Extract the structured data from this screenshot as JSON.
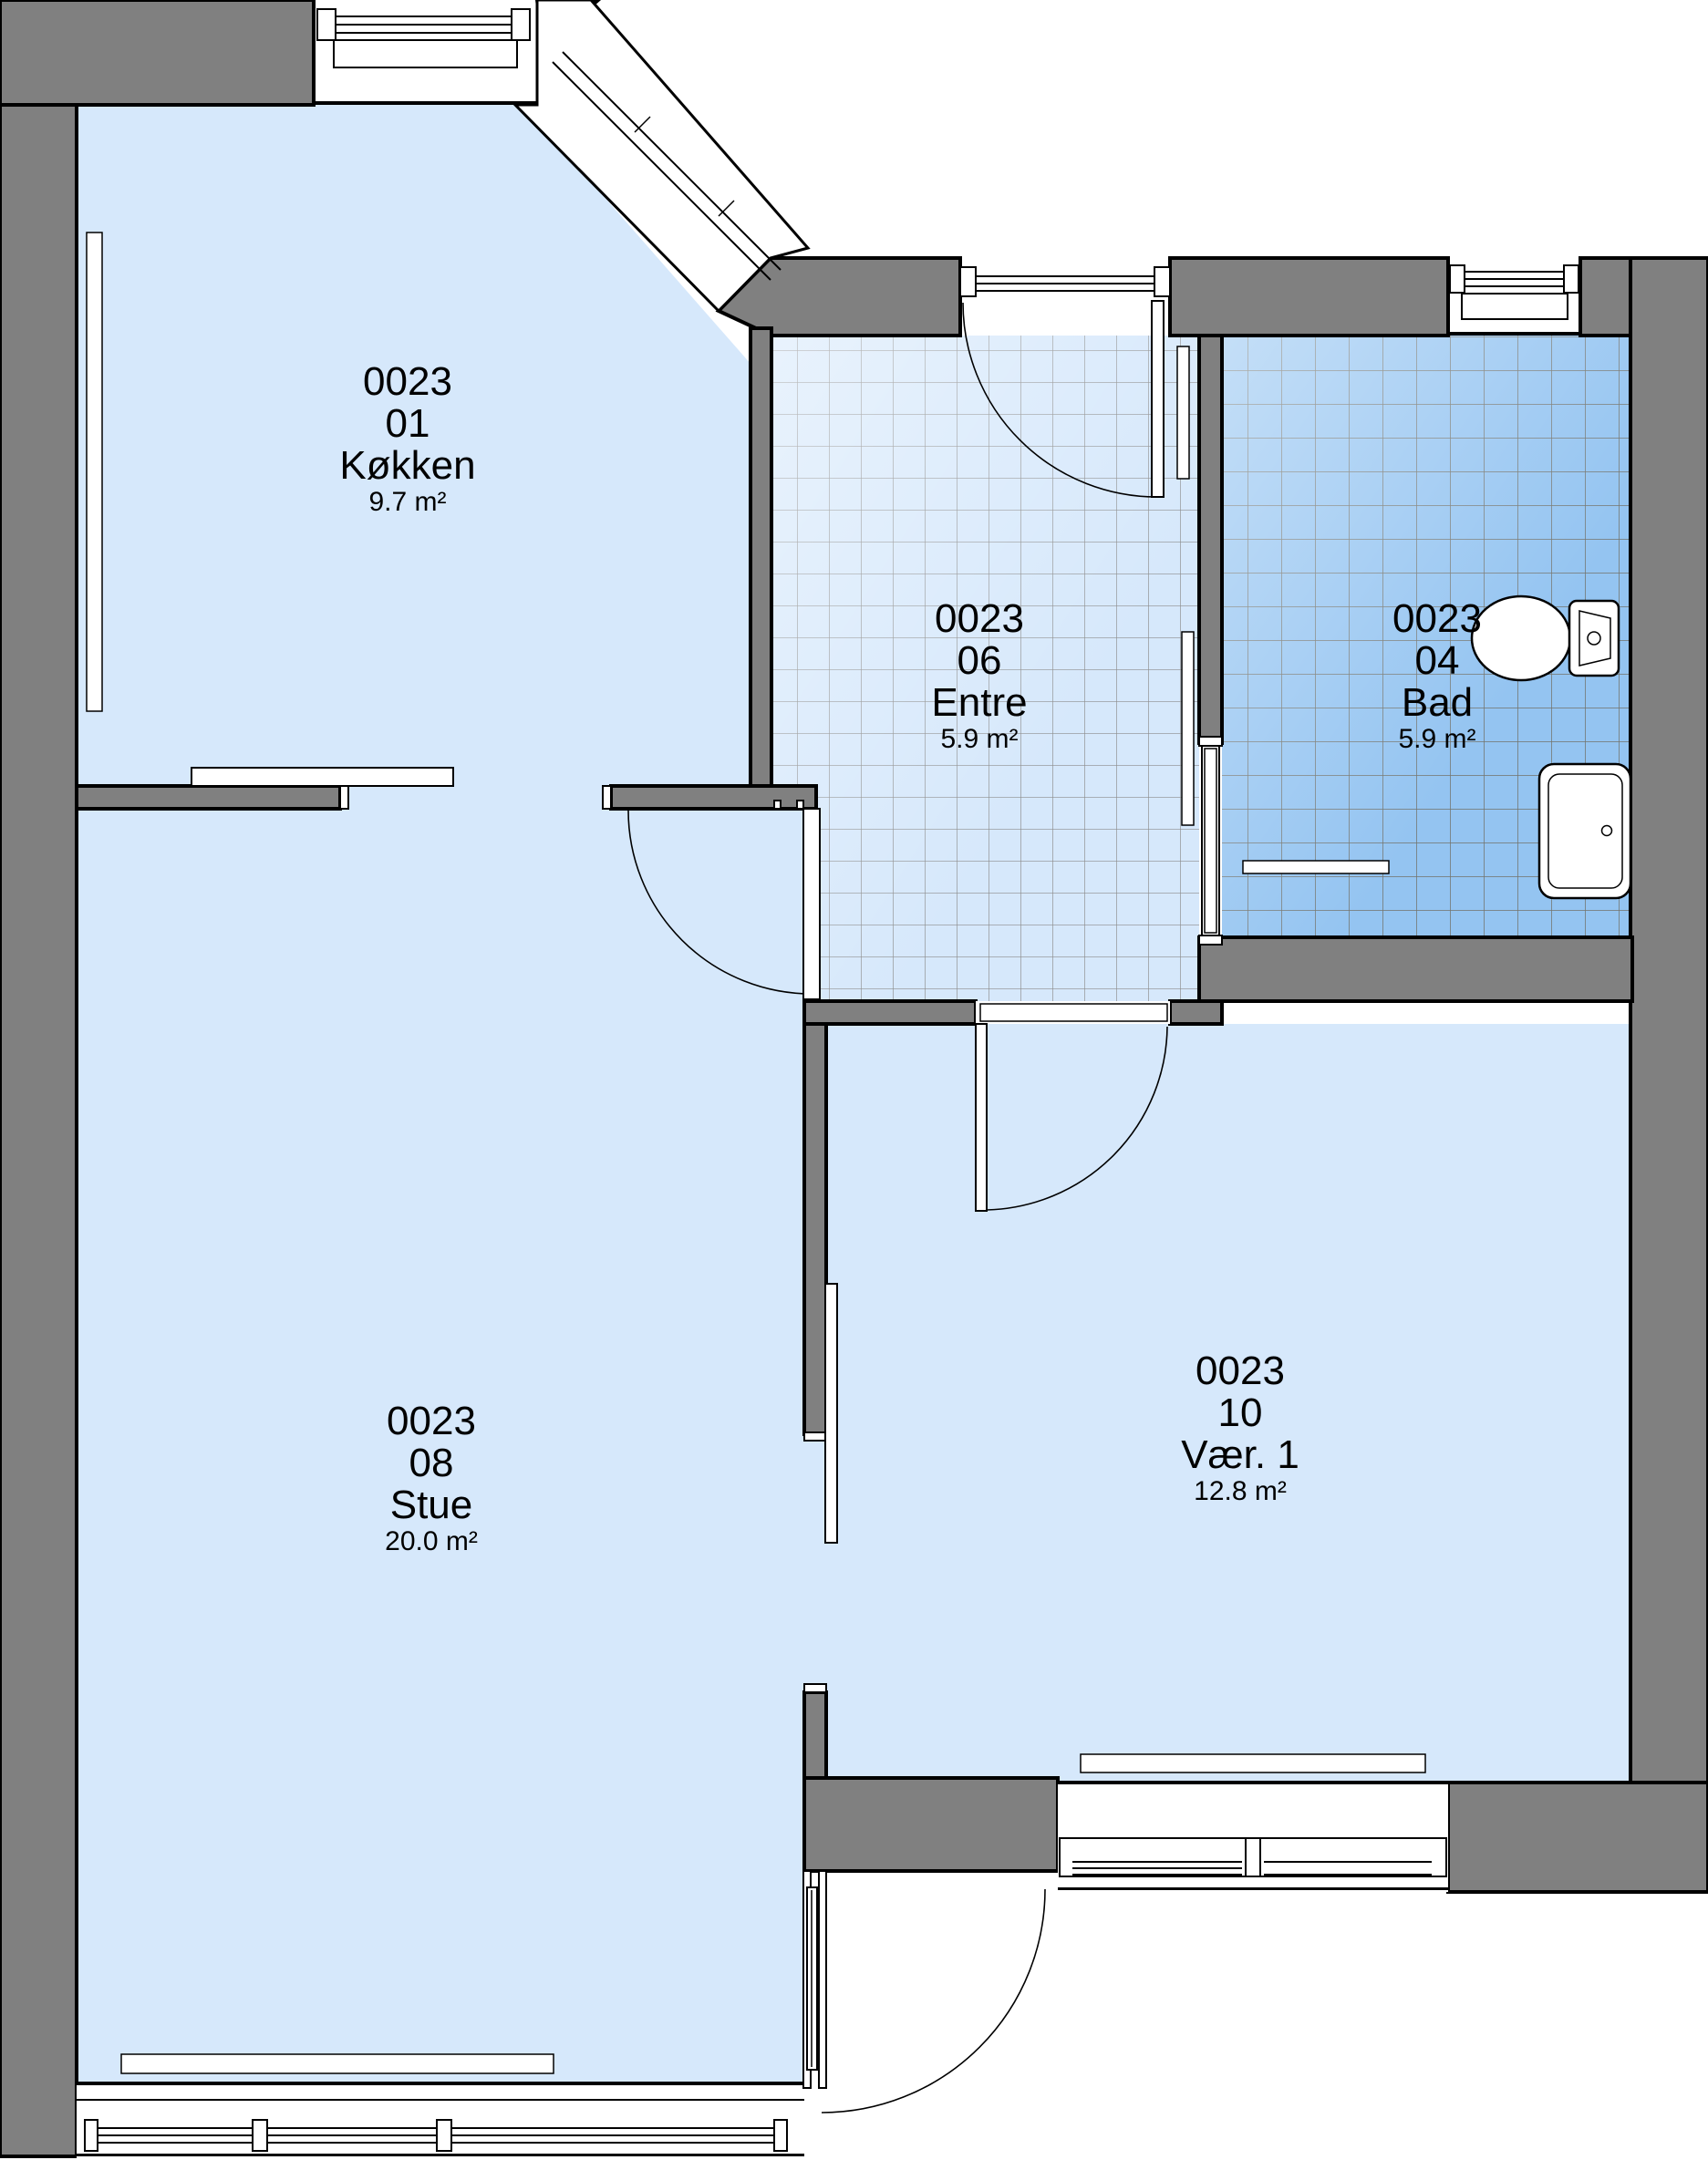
{
  "plan": {
    "unit_id": "0023",
    "rooms": [
      {
        "id": "0023",
        "number": "01",
        "name": "Køkken",
        "area": "9.7 m²"
      },
      {
        "id": "0023",
        "number": "06",
        "name": "Entre",
        "area": "5.9 m²"
      },
      {
        "id": "0023",
        "number": "04",
        "name": "Bad",
        "area": "5.9 m²"
      },
      {
        "id": "0023",
        "number": "08",
        "name": "Stue",
        "area": "20.0 m²"
      },
      {
        "id": "0023",
        "number": "10",
        "name": "Vær. 1",
        "area": "12.8 m²"
      }
    ],
    "fixtures": [
      {
        "name": "toilet",
        "room": "Bad"
      },
      {
        "name": "sink",
        "room": "Bad"
      }
    ],
    "colors": {
      "wall": "#808080",
      "floor": "#D6E8FB",
      "bath_floor": "#94C4F1",
      "outline": "#000000",
      "tile_line": "#8C8C8C"
    }
  }
}
